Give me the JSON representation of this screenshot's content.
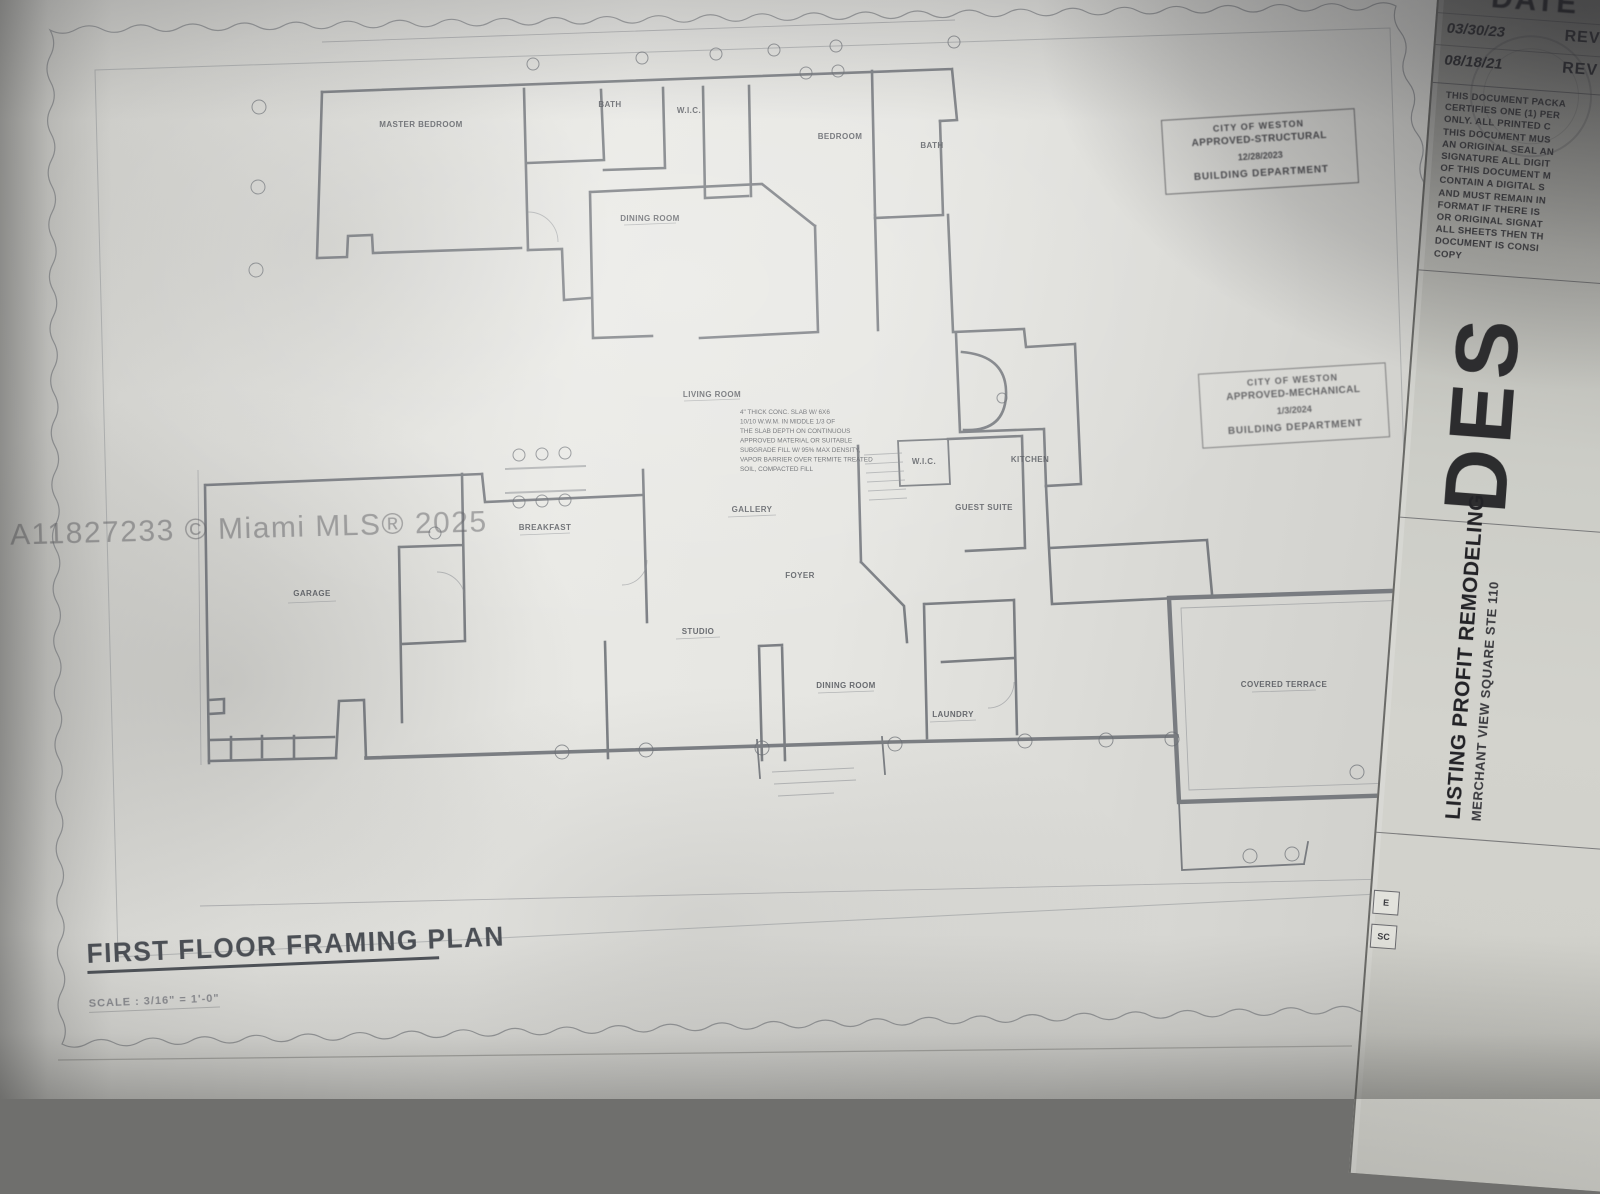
{
  "photo": {
    "watermark": "A11827233 © Miami MLS® 2025"
  },
  "titleblock": {
    "title": "FIRST FLOOR FRAMING PLAN",
    "scale": "SCALE :  3/16\" = 1'-0\""
  },
  "stamps": {
    "structural": {
      "city": "CITY OF WESTON",
      "approval": "APPROVED-STRUCTURAL",
      "date": "12/28/2023",
      "dept": "BUILDING DEPARTMENT"
    },
    "mechanical": {
      "city": "CITY OF WESTON",
      "approval": "APPROVED-MECHANICAL",
      "date": "1/3/2024",
      "dept": "BUILDING DEPARTMENT"
    }
  },
  "side_panel": {
    "date_header": "DATE",
    "revisions": [
      {
        "date": "03/30/23",
        "label": "REV"
      },
      {
        "date": "08/18/21",
        "label": "REV"
      }
    ],
    "notice_lines": [
      "THIS DOCUMENT PACKA",
      "CERTIFIES ONE (1) PER",
      "ONLY. ALL PRINTED C",
      "THIS DOCUMENT MUS",
      "AN ORIGINAL SEAL AN",
      "SIGNATURE ALL DIGIT",
      "OF THIS DOCUMENT M",
      "CONTAIN A DIGITAL S",
      "AND MUST REMAIN IN",
      "FORMAT IF THERE IS",
      "OR ORIGINAL SIGNAT",
      "ALL SHEETS THEN TH",
      "DOCUMENT IS CONSI",
      "COPY"
    ],
    "logo": "DES",
    "company": "LISTING PROFIT REMODELING",
    "address": "MERCHANT VIEW SQUARE STE 110",
    "cell_e": "E",
    "cell_sc": "SC"
  },
  "plan": {
    "rooms": [
      {
        "label": "MASTER BEDROOM"
      },
      {
        "label": "BATH"
      },
      {
        "label": "W.I.C."
      },
      {
        "label": "BEDROOM"
      },
      {
        "label": "BATH"
      },
      {
        "label": "DINING ROOM"
      },
      {
        "label": "LIVING ROOM"
      },
      {
        "label": "FOYER"
      },
      {
        "label": "GALLERY"
      },
      {
        "label": "BREAKFAST"
      },
      {
        "label": "KITCHEN"
      },
      {
        "label": "W.I.C."
      },
      {
        "label": "GUEST SUITE"
      },
      {
        "label": "GARAGE"
      },
      {
        "label": "STUDIO"
      },
      {
        "label": "DINING ROOM"
      },
      {
        "label": "LAUNDRY"
      },
      {
        "label": "COVERED TERRACE"
      }
    ],
    "note_lines": [
      "4\" THICK CONC. SLAB W/ 6X6",
      "10/10 W.W.M. IN MIDDLE 1/3 OF",
      "THE SLAB DEPTH ON CONTINUOUS",
      "APPROVED MATERIAL OR SUITABLE",
      "SUBGRADE FILL W/ 95% MAX DENSITY,",
      "VAPOR BARRIER OVER TERMITE TREATED",
      "SOIL, COMPACTED FILL"
    ]
  }
}
